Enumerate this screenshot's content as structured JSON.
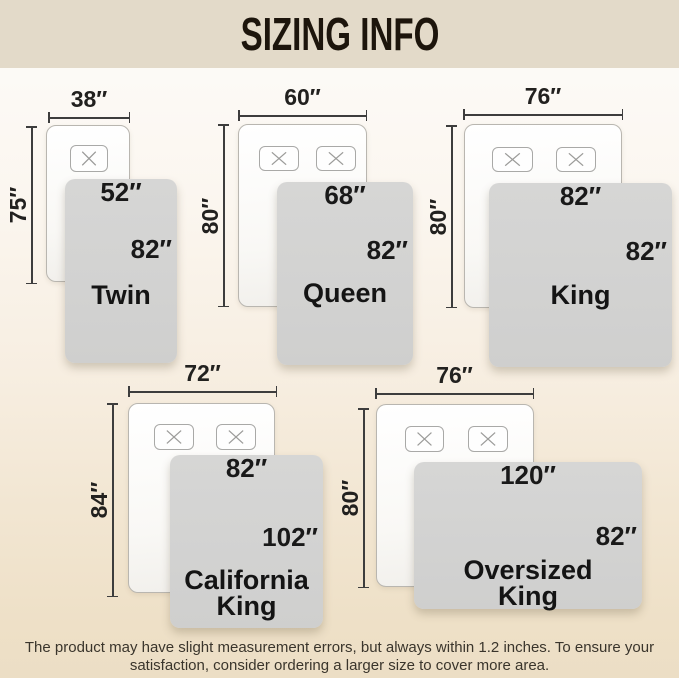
{
  "header": {
    "title": "SIZING INFO"
  },
  "beds": [
    {
      "name_lines": [
        "Twin"
      ],
      "pillow_count": 1,
      "mattress_width": "38″",
      "mattress_length": "75″",
      "blanket_width": "52″",
      "blanket_length": "82″"
    },
    {
      "name_lines": [
        "Queen"
      ],
      "pillow_count": 2,
      "mattress_width": "60″",
      "mattress_length": "80″",
      "blanket_width": "68″",
      "blanket_length": "82″"
    },
    {
      "name_lines": [
        "King"
      ],
      "pillow_count": 2,
      "mattress_width": "76″",
      "mattress_length": "80″",
      "blanket_width": "82″",
      "blanket_length": "82″"
    },
    {
      "name_lines": [
        "California",
        "King"
      ],
      "pillow_count": 2,
      "mattress_width": "72″",
      "mattress_length": "84″",
      "blanket_width": "82″",
      "blanket_length": "102″"
    },
    {
      "name_lines": [
        "Oversized",
        "King"
      ],
      "pillow_count": 2,
      "mattress_width": "76″",
      "mattress_length": "80″",
      "blanket_width": "120″",
      "blanket_length": "82″"
    }
  ],
  "footer": {
    "line1": "The product may have slight measurement errors, but always within 1.2 inches. To ensure your",
    "line2": "satisfaction, consider ordering a larger size to cover more area."
  },
  "colors": {
    "header_bg": "#e3dac9",
    "blanket_gray": "#d3d3d2",
    "text_dark": "#1a1a1a",
    "background_bottom": "#ecdec5"
  }
}
